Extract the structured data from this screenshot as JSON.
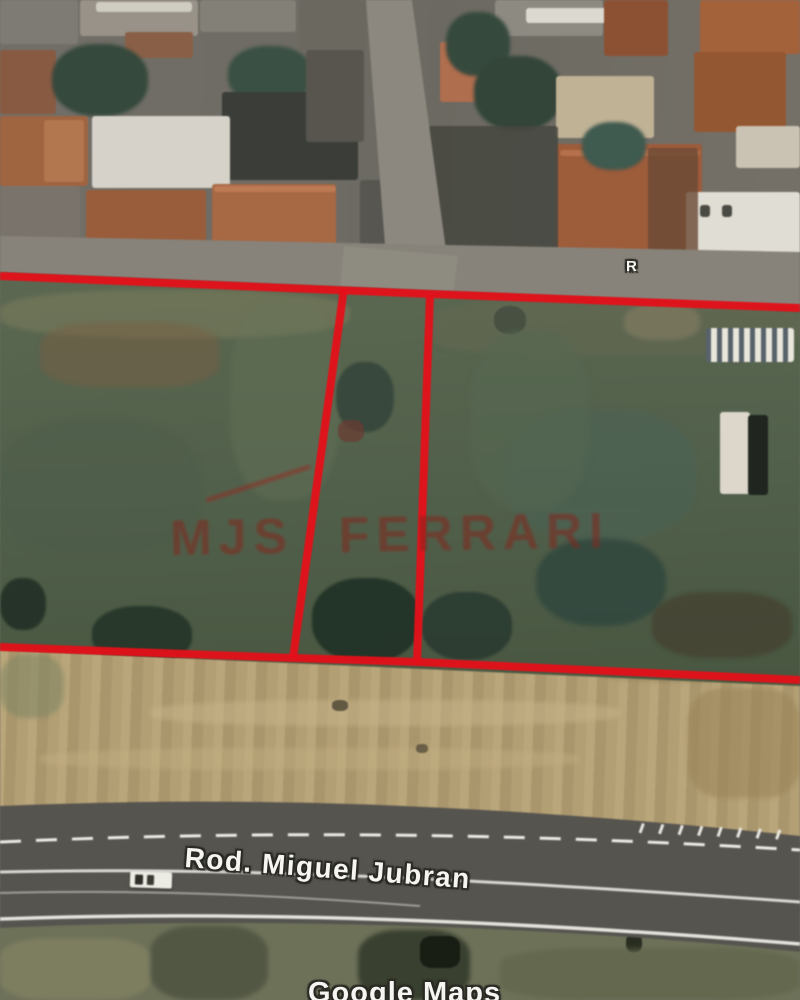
{
  "map": {
    "type": "satellite-aerial-view",
    "road_label": "Rod. Miguel Jubran",
    "street_label_partial": "R",
    "attribution": "Google Maps"
  },
  "watermark": {
    "text": "MJS FERRARI",
    "color": "#82261e"
  },
  "boundary": {
    "color": "#e51019"
  }
}
